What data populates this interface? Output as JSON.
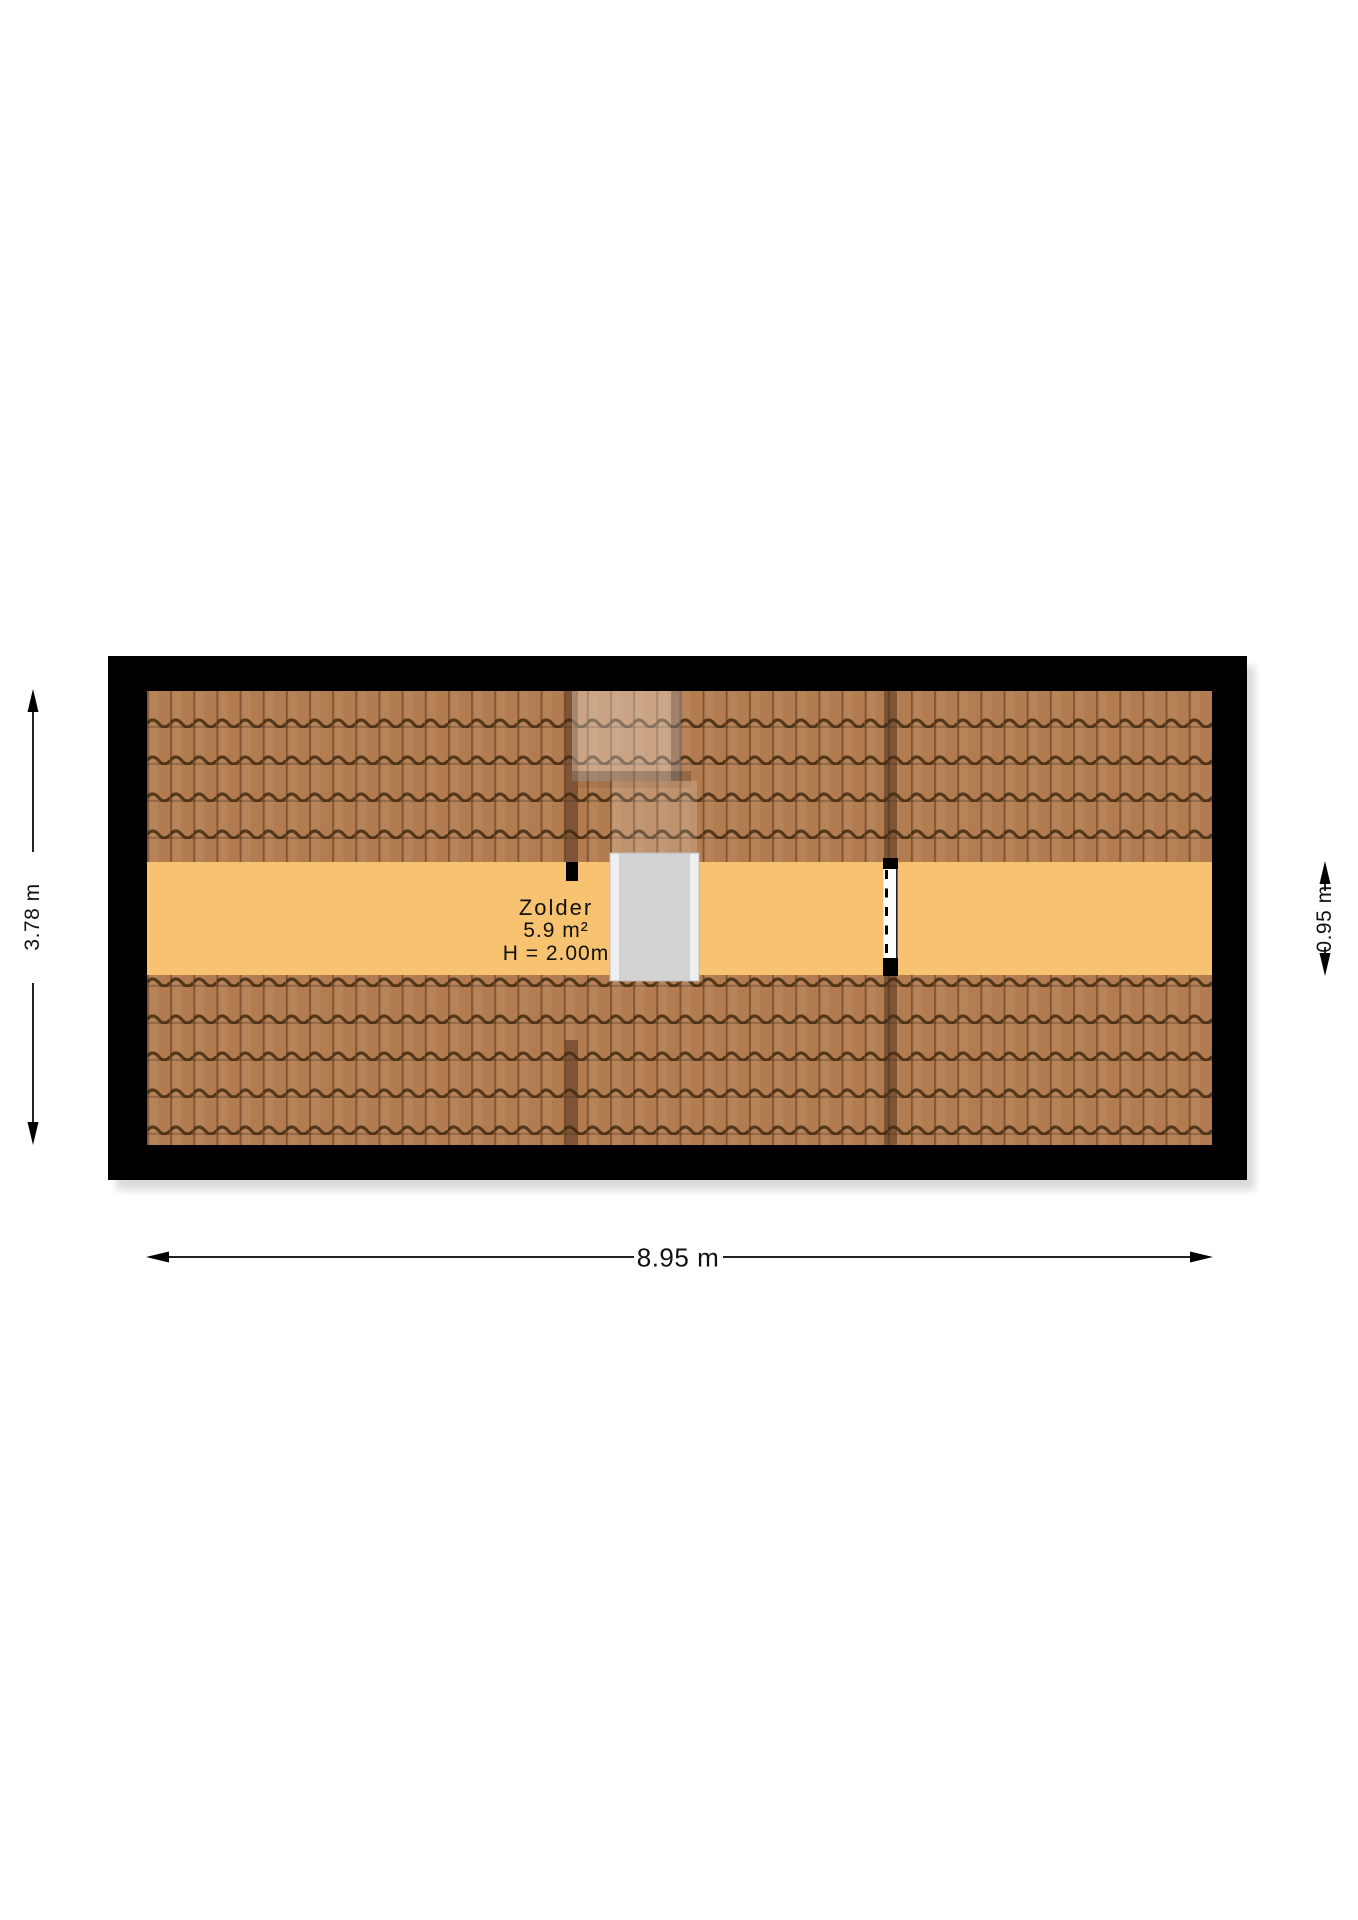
{
  "floorplan": {
    "room": {
      "name": "Zolder",
      "area": "5.9 m²",
      "ceiling_height": "H = 2.00m"
    },
    "dimensions": {
      "left_total_depth": "3.78 m",
      "right_attic_band": "0.95 m",
      "bottom_total_width": "8.95 m"
    },
    "colors": {
      "wall": "#000000",
      "roof_tile": "#b37c50",
      "roof_groove": "#7b5130",
      "roof_wave": "#432a11",
      "floor": "#f7c370",
      "skylight_glass": "#d2d2d2",
      "skylight_frame": "#efefef",
      "dimension_line": "#222222",
      "background": "#ffffff"
    }
  }
}
